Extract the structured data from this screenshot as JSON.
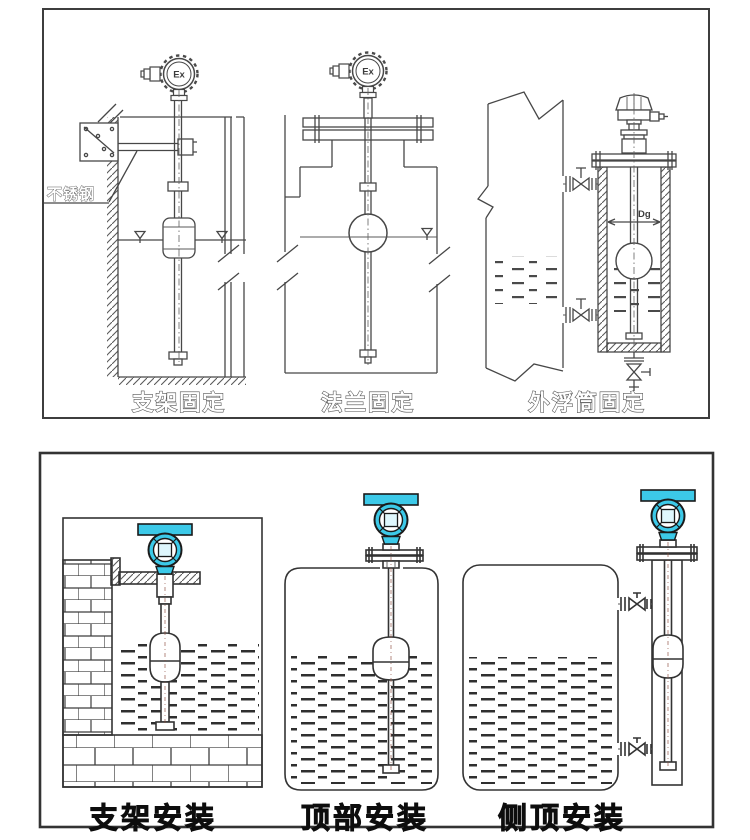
{
  "panels": {
    "top": {
      "captions": [
        "支架固定",
        "法兰固定",
        "外浮筒固定"
      ],
      "annotations": {
        "stainless_steel": "不锈钢",
        "ex_marking": "Ex",
        "chamber_diameter": "Dg"
      }
    },
    "bottom": {
      "captions": [
        "支架安装",
        "顶部安装",
        "侧顶安装"
      ]
    }
  },
  "colors": {
    "transmitter_housing_cyan": "#3cc9e8",
    "transmitter_window_light": "#dff7fd",
    "drawing_line_gray": "#474747",
    "caption_black": "#111111"
  }
}
